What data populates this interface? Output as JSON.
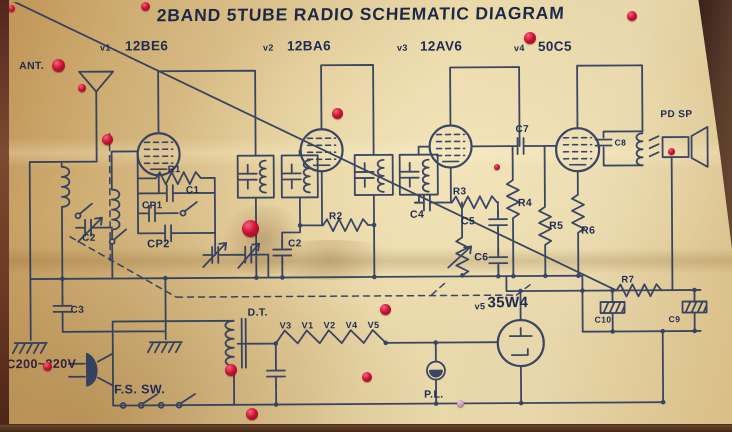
{
  "title": "2BAND 5TUBE RADIO SCHEMATIC DIAGRAM",
  "tubes": [
    {
      "designator": "v1",
      "type": "12BE6"
    },
    {
      "designator": "v2",
      "type": "12BA6"
    },
    {
      "designator": "v3",
      "type": "12AV6"
    },
    {
      "designator": "v4",
      "type": "50C5"
    },
    {
      "designator": "v5",
      "type": "35W4"
    }
  ],
  "labels": {
    "ant": "ANT.",
    "r1": "R1",
    "c1": "C1",
    "cp1": "CP1",
    "cp2": "CP2",
    "c2_tuning": "C2",
    "c3": "C3",
    "c2_bypass": "C2",
    "r2": "R2",
    "r3": "R3",
    "c4": "C4",
    "c5": "C5",
    "c6": "C6",
    "c7": "C7",
    "c8": "C8",
    "r4": "R4",
    "r5": "R5",
    "r6": "R6",
    "r7": "R7",
    "c9": "C9",
    "c10": "C10",
    "pd_sp": "PD SP",
    "dt": "D.T.",
    "pl": "P.L.",
    "fs_sw": "F.S. SW.",
    "ac": "AC200~220V"
  },
  "heater": [
    "V3",
    "V1",
    "V2",
    "V4",
    "V5"
  ],
  "colors": {
    "ink": "#2b3a5e",
    "paper": "#e0c995",
    "paint_dot": "#cf1236"
  },
  "paint_drops": [
    {
      "x": 8,
      "y": 5,
      "d": 7
    },
    {
      "x": 141,
      "y": 2,
      "d": 9
    },
    {
      "x": 52,
      "y": 59,
      "d": 13
    },
    {
      "x": 78,
      "y": 84,
      "d": 8
    },
    {
      "x": 102,
      "y": 134,
      "d": 11
    },
    {
      "x": 242,
      "y": 220,
      "d": 17
    },
    {
      "x": 332,
      "y": 108,
      "d": 11
    },
    {
      "x": 524,
      "y": 32,
      "d": 12
    },
    {
      "x": 494,
      "y": 164,
      "d": 6
    },
    {
      "x": 668,
      "y": 148,
      "d": 7
    },
    {
      "x": 627,
      "y": 11,
      "d": 10
    },
    {
      "x": 380,
      "y": 304,
      "d": 11
    },
    {
      "x": 362,
      "y": 372,
      "d": 10
    },
    {
      "x": 225,
      "y": 364,
      "d": 12
    },
    {
      "x": 246,
      "y": 408,
      "d": 12
    },
    {
      "x": 43,
      "y": 362,
      "d": 9
    },
    {
      "x": 457,
      "y": 400,
      "d": 7,
      "light": true
    }
  ]
}
